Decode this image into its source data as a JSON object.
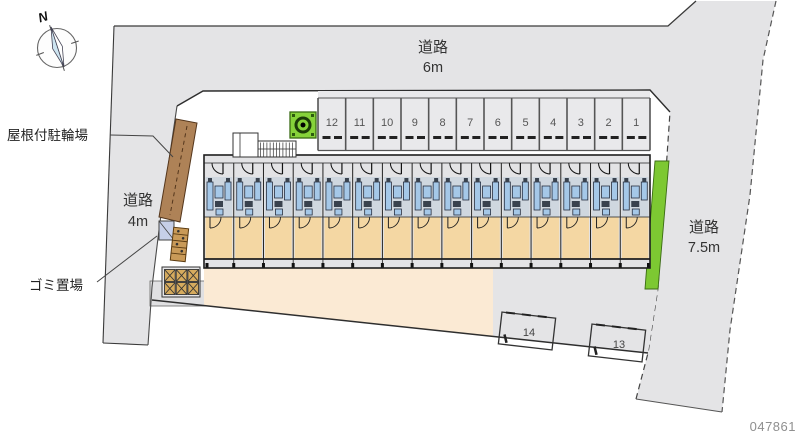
{
  "plan": {
    "plan_number": "047861",
    "compass_north": "N",
    "labels": {
      "covered_bicycle_parking": "屋根付駐輪場",
      "garbage_area": "ゴミ置場"
    },
    "roads": {
      "left": {
        "name": "道路",
        "width": "4m"
      },
      "top": {
        "name": "道路",
        "width": "6m"
      },
      "right": {
        "name": "道路",
        "width": "7.5m"
      }
    },
    "parking": {
      "top_row": [
        "12",
        "11",
        "10",
        "9",
        "8",
        "7",
        "6",
        "5",
        "4",
        "3",
        "2",
        "1"
      ],
      "south_row": [
        "14",
        "13"
      ]
    },
    "building": {
      "unit_count": 15
    }
  },
  "colors": {
    "road_gray": "#e4e4e6",
    "stall_gray": "#e9e9eb",
    "building_gray": "#e3e3e5",
    "corridor_gray": "#e2e2e4",
    "blue_zone_bg": "#cfd7df",
    "fixture_blue": "#a5c8e8",
    "fixture_dark": "#39424e",
    "room_beige": "#f4d7a3",
    "ground_peach": "#fbead4",
    "green": "#7dc832",
    "green_dark": "#2f6312",
    "brown_strip": "#ae8257",
    "brown_dark": "#54361c",
    "rack_tan": "#c99a58",
    "garbage_square": "#d6ab5e",
    "pad_gray": "#e0e0e2",
    "blue_box": "#c6cfe8",
    "line_dark": "#333333",
    "number_gray": "#555555",
    "plan_number_color": "#8f8f8f"
  }
}
